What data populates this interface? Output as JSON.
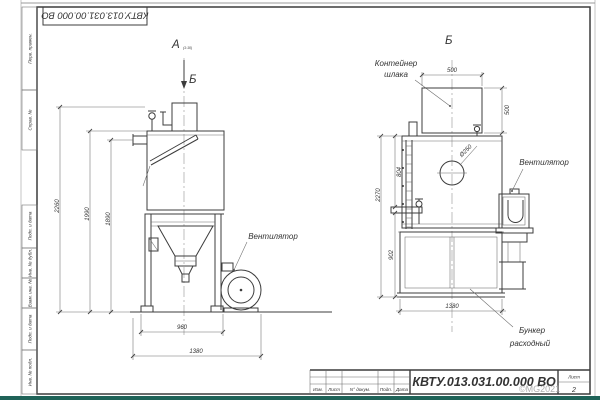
{
  "sheet": {
    "doc_number": "КВТУ.013.031.00.000 ВО",
    "sheet_label": "Лист",
    "sheet_number": "2",
    "rev_headers": [
      "Изм.",
      "Лист",
      "N° докум.",
      "Подп.",
      "Дата"
    ],
    "margin_labels": [
      "Перв. примен.",
      "Справ. №",
      "Подп. и дата",
      "Инв. № дубл.",
      "Взам. инв. №",
      "Подп. и дата",
      "Инв. № подл."
    ],
    "watermark": "©MG2021"
  },
  "views": {
    "a_label": "А",
    "a_scale": "(1:10)",
    "b_arrow_label": "Б",
    "b_label": "Б"
  },
  "labels": {
    "fan": "Вентилятор",
    "container_1": "Контейнер",
    "container_2": "шлака",
    "bunker_1": "Бункер",
    "bunker_2": "расходный",
    "hole_dia": "Ø250"
  },
  "dims": {
    "a_h1": "2260",
    "a_h2": "1990",
    "a_h3": "1890",
    "a_w1": "960",
    "a_w2": "1380",
    "b_cw": "500",
    "b_ch": "500",
    "b_h1": "2270",
    "b_h2": "804",
    "b_h3": "902",
    "b_w1": "1380"
  }
}
